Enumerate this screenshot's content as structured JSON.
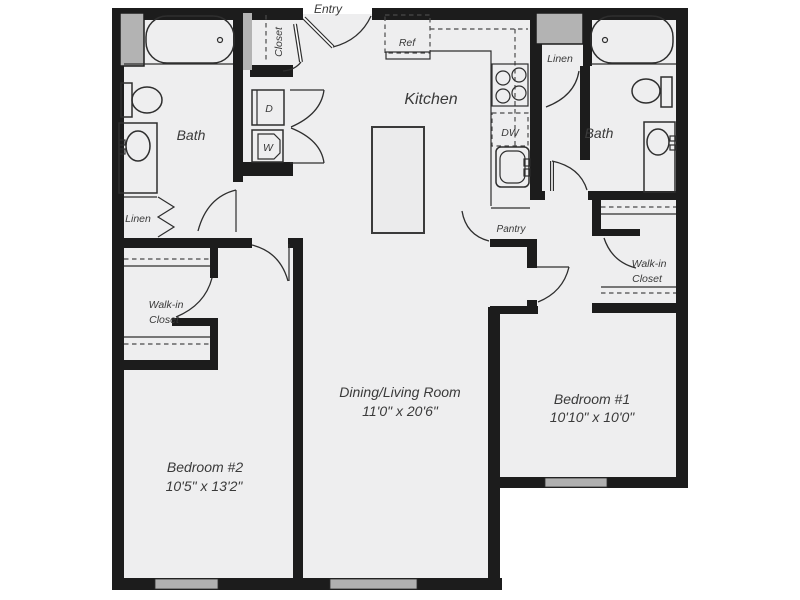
{
  "plan": {
    "rooms": {
      "entry": {
        "label": "Entry"
      },
      "entry_closet": {
        "label": "Closet"
      },
      "kitchen": {
        "label": "Kitchen"
      },
      "dining_living": {
        "label": "Dining/Living Room",
        "dimensions": "11'0\" x 20'6\""
      },
      "bedroom1": {
        "label": "Bedroom #1",
        "dimensions": "10'10\" x 10'0\""
      },
      "bedroom2": {
        "label": "Bedroom #2",
        "dimensions": "10'5\" x 13'2\""
      },
      "bath1": {
        "label": "Bath"
      },
      "bath2": {
        "label": "Bath"
      },
      "walk_in_closet1": {
        "label_line1": "Walk-in",
        "label_line2": "Closet"
      },
      "walk_in_closet2": {
        "label_line1": "Walk-in",
        "label_line2": "Closet"
      },
      "linen1": {
        "label": "Linen"
      },
      "linen2": {
        "label": "Linen"
      },
      "pantry": {
        "label": "Pantry"
      }
    },
    "appliances": {
      "refrigerator": {
        "label": "Ref"
      },
      "dishwasher": {
        "label": "DW"
      },
      "dryer": {
        "label": "D"
      },
      "washer": {
        "label": "W"
      }
    },
    "colors": {
      "wall": "#1c1c1c",
      "floor": "#eeeeef",
      "window_gray": "#b0b0b0",
      "chase_gray": "#b3b3b3",
      "text": "#3a3a3a"
    }
  }
}
